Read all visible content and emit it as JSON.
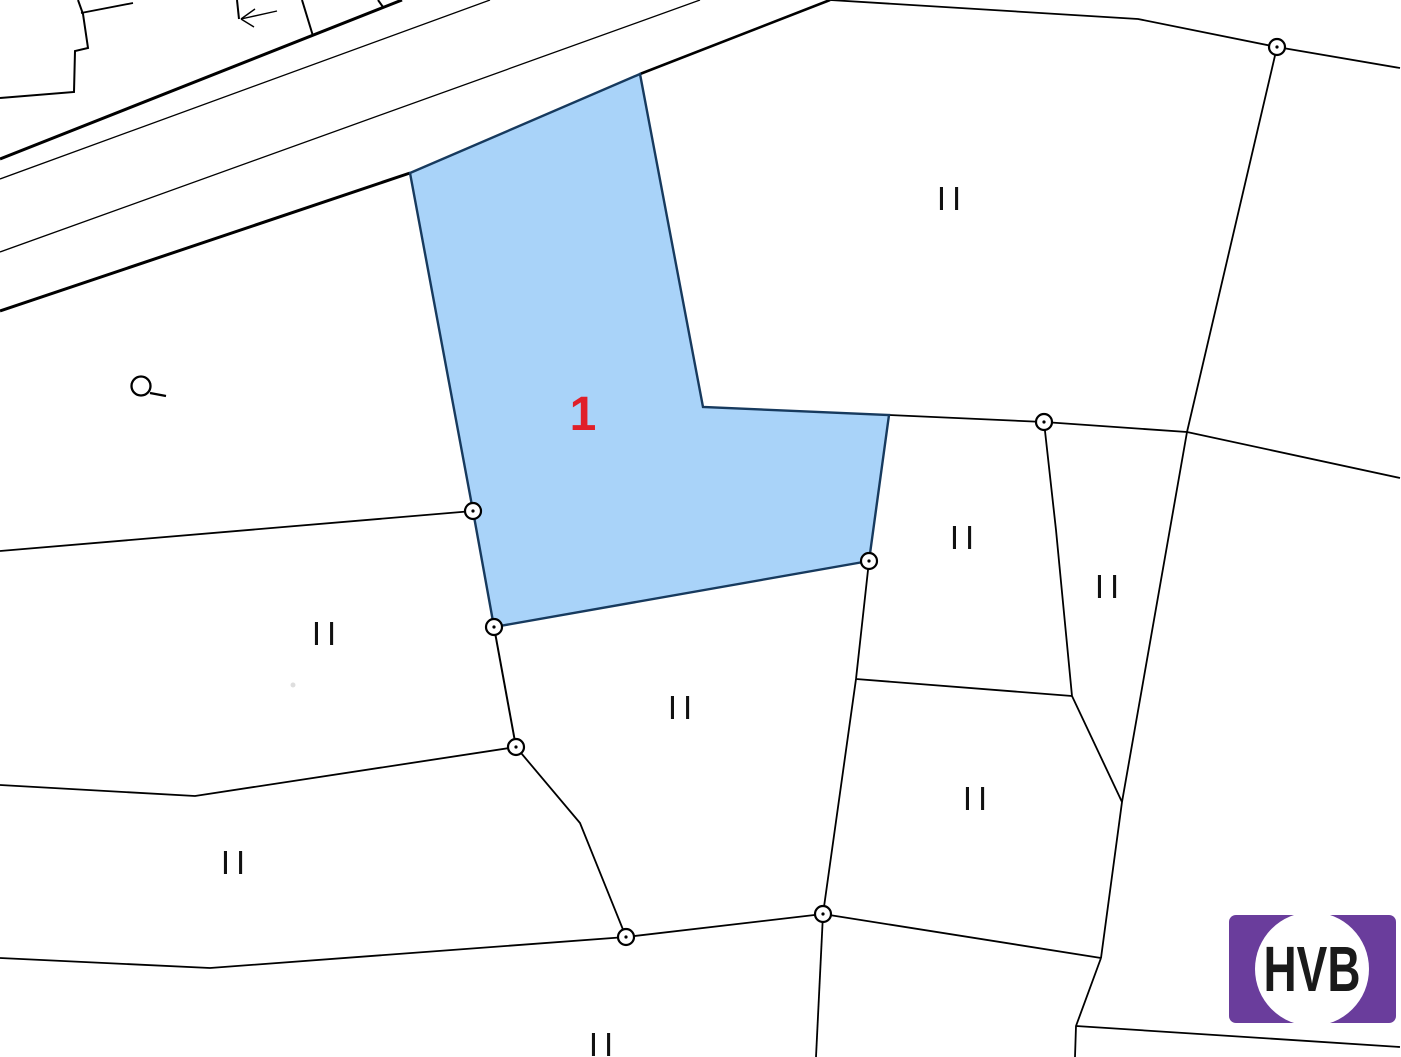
{
  "map": {
    "background": "#ffffff",
    "line_color": "#000000",
    "parcel1": {
      "label": "1",
      "label_color": "#e01f29",
      "label_pos": {
        "x": 583,
        "y": 430
      },
      "fill": "#a9d3f9",
      "stroke": "#173a5e",
      "stroke_width": 2.4,
      "points": "410,173 640,74 703,407 889,415 869,561 494,627 473,511"
    },
    "boundaries": [
      {
        "name": "road-edge-upper",
        "w": 3,
        "pts": "0,159 402,0"
      },
      {
        "name": "road-lane-upper",
        "w": 1.3,
        "pts": "0,179 490,0"
      },
      {
        "name": "road-lane-lower",
        "w": 1.3,
        "pts": "0,252 700,0"
      },
      {
        "name": "road-edge-lower-west",
        "w": 3,
        "pts": "0,311 410,173"
      },
      {
        "name": "road-edge-lower-east",
        "w": 2.6,
        "pts": "640,74 830,0"
      },
      {
        "name": "building-steps",
        "w": 2,
        "pts": "0,98 74,92 75,51 88,48 83,14 78,0"
      },
      {
        "name": "building-roof",
        "w": 1.8,
        "pts": "81,13 133,3"
      },
      {
        "name": "building-edge-a",
        "w": 2,
        "pts": "237,0 239,19"
      },
      {
        "name": "building-edge-b",
        "w": 2,
        "pts": "302,0 313,36"
      },
      {
        "name": "building-edge-c",
        "w": 2,
        "pts": "378,0 383,7"
      },
      {
        "name": "arrow-shaft",
        "w": 1.4,
        "pts": "277,11 241,19"
      },
      {
        "name": "arrow-barb-1",
        "w": 1.4,
        "pts": "255,9 241,19"
      },
      {
        "name": "arrow-barb-2",
        "w": 1.4,
        "pts": "254,27 241,19"
      },
      {
        "name": "boundary-north",
        "w": 1.8,
        "pts": "830,0 1138,19 1277,47"
      },
      {
        "name": "boundary-northeast",
        "w": 1.8,
        "pts": "1277,47 1400,68"
      },
      {
        "name": "boundary-east-upper",
        "w": 1.8,
        "pts": "1277,47 1187,432"
      },
      {
        "name": "boundary-mid",
        "w": 1.8,
        "pts": "889,415 1044,422 1187,432 1400,478"
      },
      {
        "name": "boundary-east-long",
        "w": 1.8,
        "pts": "1187,432 1122,802 1101,958"
      },
      {
        "name": "boundary-right-parcel-west",
        "w": 1.8,
        "pts": "1044,422 1056,530 1072,696"
      },
      {
        "name": "boundary-right-parcel-south",
        "w": 1.8,
        "pts": "856,679 1072,696"
      },
      {
        "name": "boundary-right-diagonal",
        "w": 1.8,
        "pts": "1072,696 1122,802"
      },
      {
        "name": "boundary-middle-east",
        "w": 1.8,
        "pts": "869,561 856,679 823,914"
      },
      {
        "name": "boundary-south-1",
        "w": 1.8,
        "pts": "823,914 1101,958"
      },
      {
        "name": "boundary-south-2",
        "w": 1.8,
        "pts": "1101,958 1076,1026 1075,1057"
      },
      {
        "name": "boundary-south-3",
        "w": 1.8,
        "pts": "1076,1026 1400,1047"
      },
      {
        "name": "boundary-west-1",
        "w": 1.8,
        "pts": "0,551 473,511"
      },
      {
        "name": "boundary-left-edge",
        "w": 2,
        "pts": "494,627 516,747"
      },
      {
        "name": "boundary-west-2",
        "w": 1.8,
        "pts": "0,785 195,796 516,747"
      },
      {
        "name": "boundary-mid-south",
        "w": 1.8,
        "pts": "516,747 580,823 626,937"
      },
      {
        "name": "boundary-west-3",
        "w": 1.8,
        "pts": "0,958 210,968 626,937"
      },
      {
        "name": "boundary-bottom-1",
        "w": 1.8,
        "pts": "626,937 823,914"
      },
      {
        "name": "boundary-bottom-2",
        "w": 1.8,
        "pts": "823,914 816,1057"
      }
    ],
    "vertices": [
      {
        "x": 1277,
        "y": 47
      },
      {
        "x": 1044,
        "y": 422
      },
      {
        "x": 473,
        "y": 511
      },
      {
        "x": 494,
        "y": 627
      },
      {
        "x": 869,
        "y": 561
      },
      {
        "x": 516,
        "y": 747
      },
      {
        "x": 626,
        "y": 937
      },
      {
        "x": 823,
        "y": 914
      }
    ],
    "vertex_style": {
      "radius": 8,
      "stroke": "#000000",
      "stroke_width": 2.2,
      "fill": "#ffffff",
      "dot_radius": 1.6
    },
    "zone_labels": [
      {
        "text": "II",
        "x": 952,
        "y": 210
      },
      {
        "text": "II",
        "x": 327,
        "y": 645
      },
      {
        "text": "II",
        "x": 236,
        "y": 874
      },
      {
        "text": "II",
        "x": 683,
        "y": 719
      },
      {
        "text": "II",
        "x": 965,
        "y": 549
      },
      {
        "text": "II",
        "x": 1110,
        "y": 598
      },
      {
        "text": "II",
        "x": 978,
        "y": 810
      },
      {
        "text": "II",
        "x": 604,
        "y": 1056
      }
    ],
    "lamp_symbol": {
      "cx": 141,
      "cy": 386,
      "r": 9.5,
      "stroke_width": 2.3,
      "tail": "150,393 166,396"
    },
    "faint_mark": {
      "cx": 293,
      "cy": 685,
      "r": 2.5,
      "fill": "#c8c8c8"
    }
  },
  "logo": {
    "text": "HVB",
    "bg_color": "#6a3d9c",
    "text_color": "#1a1a1a",
    "rect": {
      "x": 1229,
      "y": 915,
      "w": 167,
      "h": 108,
      "rx": 7
    },
    "circle": {
      "cx": 1312,
      "cy": 969,
      "r": 57
    },
    "text_pos": {
      "x": 1312,
      "y": 991,
      "length": 97
    }
  }
}
